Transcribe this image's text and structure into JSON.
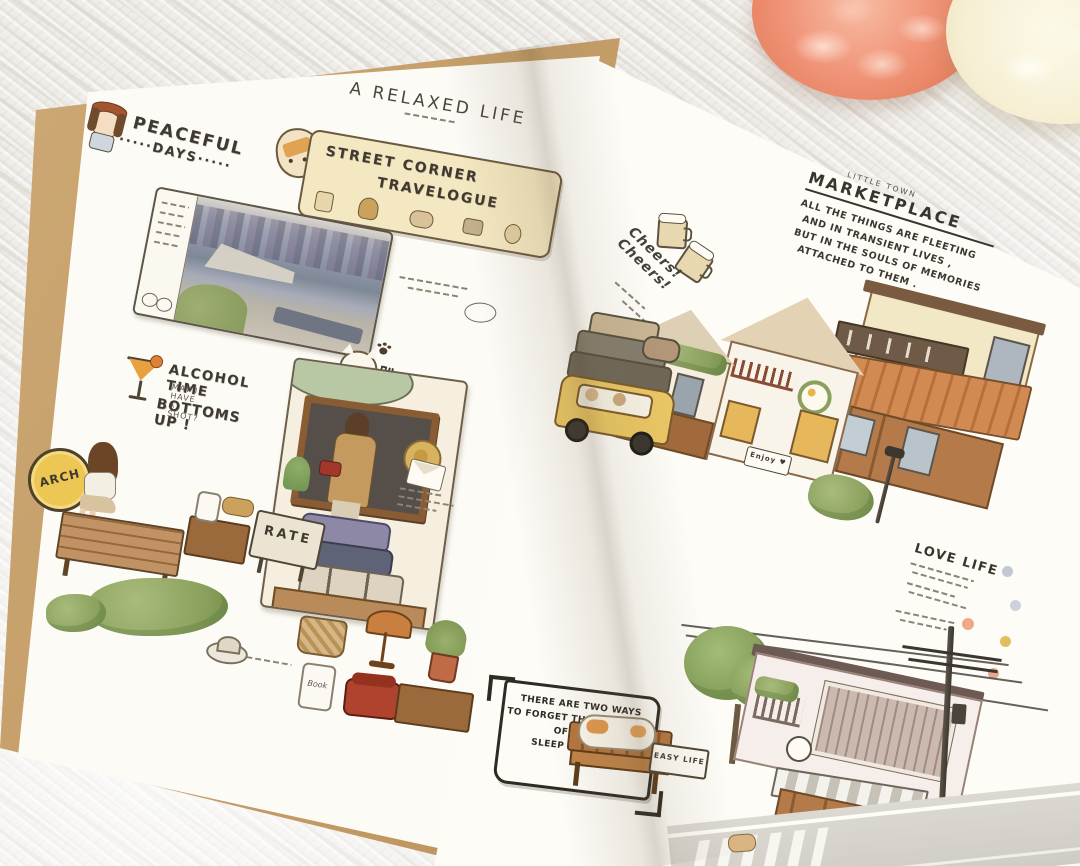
{
  "photo": {
    "subject": "open illustrated journal spread with watercolor town stickers on a knitted blanket",
    "colors": {
      "blanket": "#efede9",
      "kraft_cover": "#c09660",
      "page": "#fcfbf6",
      "ink": "#3f3931",
      "banner_cream": "#f4e8c2",
      "coral_flower": "#f09478",
      "cream_flower": "#f6efd4",
      "awning_orange": "#cb8150",
      "foliage_green": "#8aa05c",
      "wood_brown": "#b5834f",
      "car_yellow": "#e9c664"
    }
  },
  "left_page": {
    "peaceful_days": {
      "line1": "PEACEFUL",
      "line2": "·····DAYS·····"
    },
    "relaxed_life": {
      "title": "A RELAXED LIFE"
    },
    "travelogue_banner": {
      "line1": "STREET CORNER",
      "line2": "TRAVELOGUE"
    },
    "alcohol_time": {
      "title": "ALCOHOL TIME",
      "subtitle": "MAY I HAVE A SHOT?",
      "cheer": "BOTTOMS UP !"
    },
    "paw_cat_caption": {
      "title": "趴趴猫",
      "heart": "♥"
    },
    "arch_badge": {
      "label": "ARCH"
    },
    "rate_sign": {
      "label": "RATE"
    },
    "book_jar": {
      "label": "Book"
    }
  },
  "right_page": {
    "cheers_stamp": {
      "text": "Cheers! Cheers!",
      "music": "♪ ♫"
    },
    "marketplace": {
      "overline": "LITTLE TOWN",
      "title": "MARKETPLACE",
      "lines": [
        "ALL THE THINGS ARE FLEETING",
        "AND IN TRANSIENT LIVES ,",
        "BUT IN THE SOULS OF MEMORIES",
        "ATTACHED TO THEM ."
      ]
    },
    "enjoy_sign": {
      "label": "Enjoy ♥"
    },
    "love_life": {
      "title": "LOVE LIFE"
    },
    "note_box": {
      "lines": [
        "THERE ARE TWO WAYS",
        "TO FORGET THE TROUBLES",
        "OF LIFE :",
        "SLEEP AND CATS"
      ]
    },
    "easy_tag": {
      "label": "EASY LIFE"
    }
  }
}
